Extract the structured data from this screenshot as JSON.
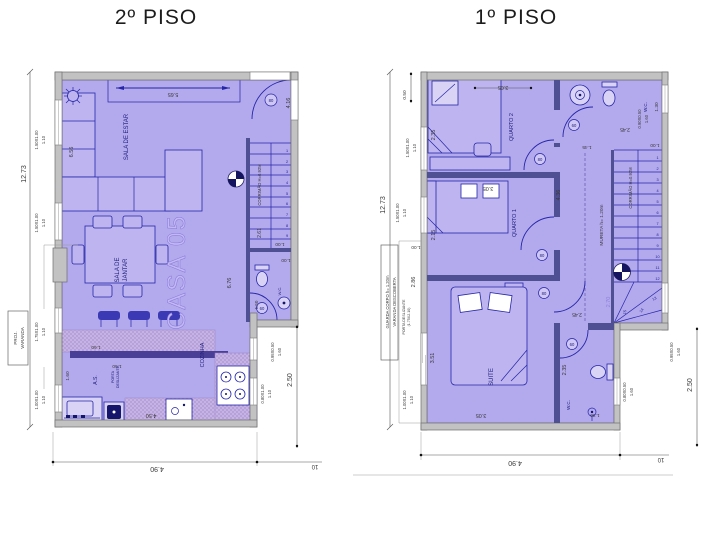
{
  "palette": {
    "room_fill": "#b3a9ed",
    "wall_gray": "#c2c2c2",
    "furniture_line": "#2626a8",
    "interior_wall": "#4f4f94",
    "counter_hatch": "#c7b2e4",
    "watermark": "#c3b8f4",
    "dim_text": "#3a3a3a",
    "title_text": "#1c1c1c"
  },
  "left": {
    "title": "2º PISO",
    "watermark": "CASA 05",
    "rooms": {
      "sala_estar": "SALA DE ESTAR",
      "sala_de": "SALA DE",
      "jantar": "JANTAR",
      "cozinha": "COZINHA",
      "as_": "A.S.",
      "wc": "W.C."
    },
    "dims": {
      "v_total": "12.73",
      "top": "5.65",
      "sala": "6.56",
      "hall": "6.76",
      "right_top": "4.16",
      "stair_run": "2.61",
      "stair_w": "1.00",
      "wc_w": "1.00",
      "wc_d": "1.50",
      "c160a": "1.60",
      "c160b": "1.60",
      "c160c": "1.60",
      "kitchen": "4.50",
      "right_v": "2.50",
      "bottom": "4.90",
      "bottom_r": "10"
    },
    "win": {
      "w1a": "1.50X1.00",
      "w1b": "1.10",
      "w2a": "1.50X1.00",
      "w2b": "1.10",
      "w3a": "1.75X1.00",
      "w3b": "1.10",
      "w4a": "1.00X1.00",
      "w4b": "1.10",
      "w5a": "0.95X0.50",
      "w5b": "1.60",
      "w6a": "0.80X1.00",
      "w6b": "1.10"
    },
    "notes": {
      "corrimao": "CORRIMÃO H=0.92M",
      "porta1": "PORTA",
      "porta2": "DESLIZANTE",
      "proj1": "PROJ.",
      "proj2": "VARANDA"
    },
    "doors": {
      "entrance": "80",
      "wc": "60"
    },
    "stairs": [
      "1",
      "2",
      "3",
      "4",
      "5",
      "6",
      "7",
      "8",
      "9"
    ]
  },
  "right": {
    "title": "1º PISO",
    "rooms": {
      "quarto1": "QUARTO 1",
      "quarto2": "QUARTO 2",
      "suite": "SUITE",
      "wc": "W.C.",
      "wc_suite": "W.C."
    },
    "dims": {
      "v_total": "12.73",
      "offset": "0.50",
      "q2_w": "3.05",
      "q2_d": "2.35",
      "q1_w": "3.05",
      "q1_d": "2.15",
      "suite_w": "3.05",
      "suite_d": "3.51",
      "swc_d": "2.35",
      "swc_w": "1.30",
      "wc_top": "2.45",
      "wc_right": "1.30",
      "stair_a": "1.45",
      "stair_b": "1.00",
      "corridor": "4.36",
      "mezz": "2.70",
      "landing": "2.45",
      "varanda": "2.86",
      "varanda_b": "1.00",
      "right_v": "2.50",
      "bottom": "4.90",
      "bottom_r": "10"
    },
    "win": {
      "w1a": "1.50X1.00",
      "w1b": "1.10",
      "w2a": "1.50X1.00",
      "w2b": "1.10",
      "w3a": "1.00X1.00",
      "w3b": "1.10",
      "w4a": "0.90X0.50",
      "w4b": "1.60",
      "w5a": "0.95X0.50",
      "w5b": "1.60",
      "w6a": "0.80X0.50",
      "w6b": "1.60"
    },
    "notes": {
      "corrimao": "CORRIMÃO H=0.92M",
      "mureta": "MURETA  h=  1.20m",
      "guarda": "GUARDA CORPO h= 1.20m",
      "varanda": "VARANDA  DESCOBERTA",
      "porta": "PORTA DESLIZANTE",
      "porta_size": "(1.75X2.10)"
    },
    "doors": {
      "q2": "80",
      "q1": "80",
      "suite": "80",
      "wc": "60",
      "swc": "60"
    },
    "stairs": [
      "1",
      "2",
      "3",
      "4",
      "5",
      "6",
      "7",
      "8",
      "9",
      "10",
      "11",
      "12",
      "13",
      "14",
      "15"
    ]
  }
}
